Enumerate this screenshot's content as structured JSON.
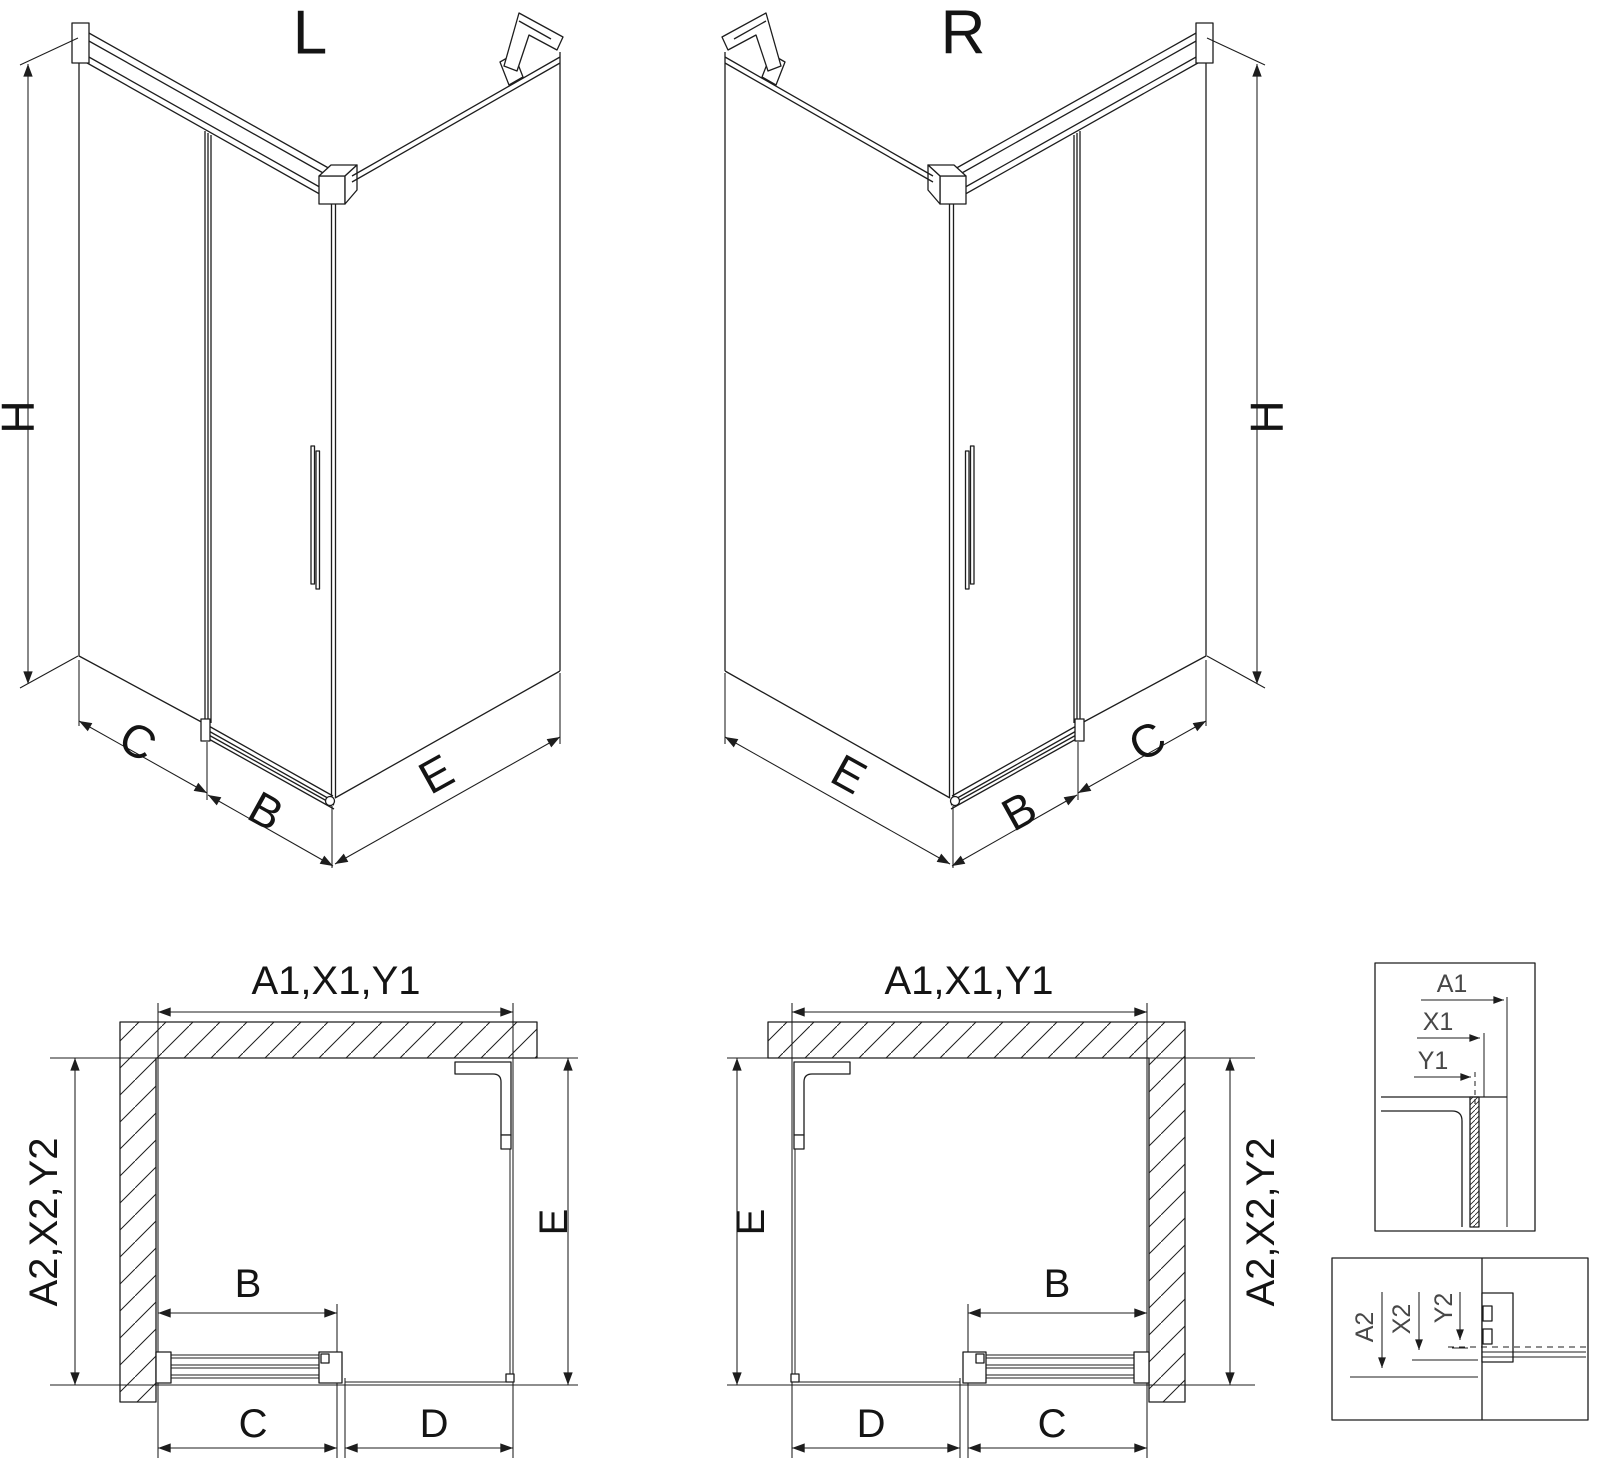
{
  "drawing": {
    "iso_left": {
      "title": "L",
      "dim_height": "H",
      "dim_side_panel": "C",
      "dim_door": "B",
      "dim_front_panel": "E"
    },
    "iso_right": {
      "title": "R",
      "dim_height": "H",
      "dim_side_panel": "C",
      "dim_door": "B",
      "dim_front_panel": "E"
    },
    "plan_left": {
      "dim_width_total": "A1,X1,Y1",
      "dim_depth_total": "A2,X2,Y2",
      "dim_depth_inner": "E",
      "dim_door": "B",
      "dim_bottom_first": "C",
      "dim_bottom_second": "D"
    },
    "plan_right": {
      "dim_width_total": "A1,X1,Y1",
      "dim_depth_total": "A2,X2,Y2",
      "dim_depth_inner": "E",
      "dim_door": "B",
      "dim_bottom_first": "D",
      "dim_bottom_second": "C"
    },
    "detail_width_profile": {
      "dim_outer": "A1",
      "dim_mid": "X1",
      "dim_inner": "Y1"
    },
    "detail_depth_profile": {
      "dim_outer": "A2",
      "dim_mid": "X2",
      "dim_inner": "Y2"
    }
  },
  "colors": {
    "line": "#1d1d1d",
    "detail_label": "#474747",
    "background": "#ffffff"
  }
}
